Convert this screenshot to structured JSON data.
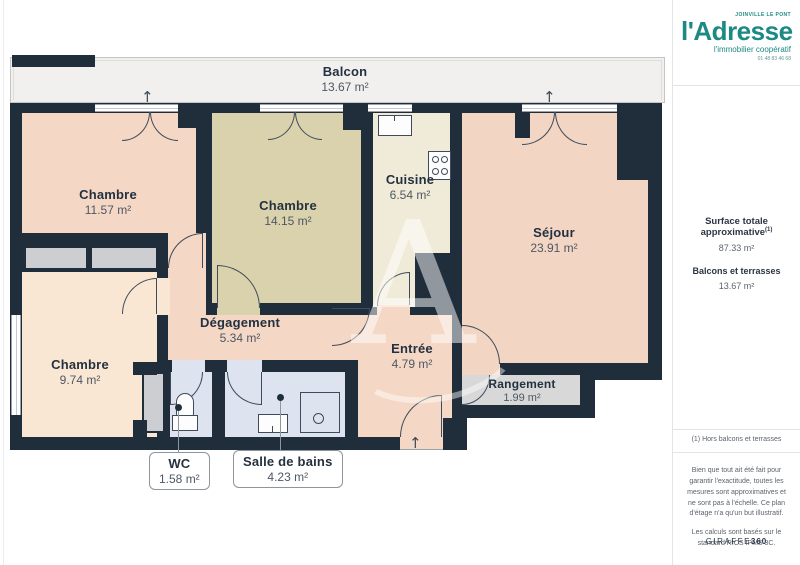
{
  "page": {
    "watermark_letter": "A"
  },
  "rooms": [
    {
      "id": "balcon",
      "name": "Balcon",
      "area": "13.67 m²"
    },
    {
      "id": "chambre-1",
      "name": "Chambre",
      "area": "11.57 m²"
    },
    {
      "id": "chambre-2",
      "name": "Chambre",
      "area": "14.15 m²"
    },
    {
      "id": "cuisine",
      "name": "Cuisine",
      "area": "6.54 m²"
    },
    {
      "id": "sejour",
      "name": "Séjour",
      "area": "23.91 m²"
    },
    {
      "id": "chambre-3",
      "name": "Chambre",
      "area": "9.74 m²"
    },
    {
      "id": "degagement",
      "name": "Dégagement",
      "area": "5.34 m²"
    },
    {
      "id": "entree",
      "name": "Entrée",
      "area": "4.79 m²"
    },
    {
      "id": "rangement",
      "name": "Rangement",
      "area": "1.99 m²"
    },
    {
      "id": "wc",
      "name": "WC",
      "area": "1.58 m²"
    },
    {
      "id": "salle-de-bains",
      "name": "Salle de bains",
      "area": "4.23 m²"
    }
  ],
  "sidebar": {
    "agency": {
      "location": "JOINVILLE LE PONT",
      "name": "l'Adresse",
      "tagline": "l'immobilier coopératif",
      "phone": "01 48 83 46 68"
    },
    "surface": {
      "label": "Surface totale approximative",
      "sup": "(1)",
      "value": "87.33 m²",
      "balconies_label": "Balcons et terrasses",
      "balconies_value": "13.67 m²"
    },
    "note": "(1) Hors balcons et terrasses",
    "disclaimer": "Bien que tout ait été fait pour garantir l'exactitude, toutes les mesures sont approximatives et ne sont pas à l'échelle. Ce plan d'étage n'a qu'un but illustratif.",
    "standard": "Les calculs sont basés sur le standard RICS IPMS 3C.",
    "brand": "GIRAFFE",
    "brand_suffix": "360"
  },
  "colors": {
    "wall": "#202e3c",
    "accent_teal": "#1b8984"
  }
}
